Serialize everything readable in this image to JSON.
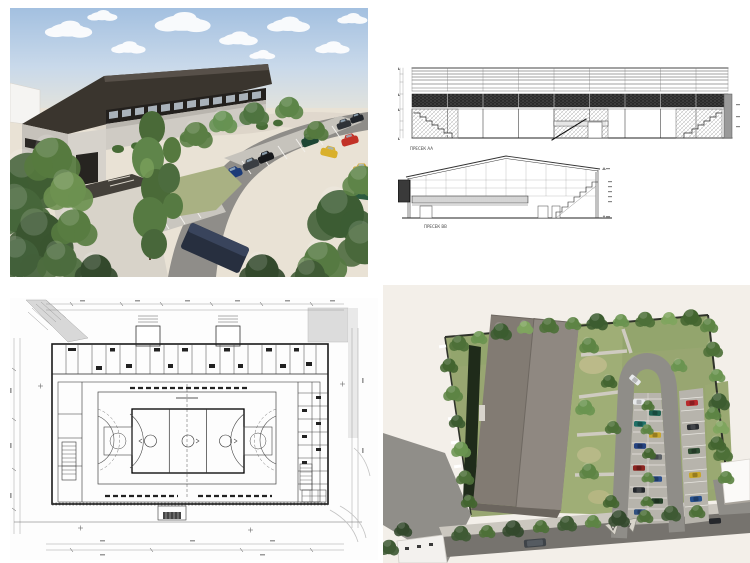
{
  "sections": {
    "label_aa": "ПРЕСЕК AA",
    "label_bb": "ПРЕСЕК BB"
  },
  "palette": {
    "page_background": "#ffffff",
    "sky_top": "#a3c0e0",
    "sky_horizon": "#e6e4da",
    "ground_beige": "#e9e2d5",
    "roof_dark": "#3a352e",
    "wall_light": "#cfcbc4",
    "site_beige": "#f3efe9",
    "aerial_roof_left": "#827b73",
    "aerial_roof_right": "#8f8881",
    "asphalt": "#8f8d88",
    "stall_concrete": "#b7b4ac",
    "grass": "#98a671",
    "tree_green": "#4d7038",
    "drawing_line": "#333333",
    "car_red": "#b8292b",
    "car_blue": "#24427f",
    "car_yellow": "#c8a62c",
    "car_green": "#2f4d33",
    "car_maroon": "#7a2c20",
    "car_white": "#e8eaec"
  }
}
